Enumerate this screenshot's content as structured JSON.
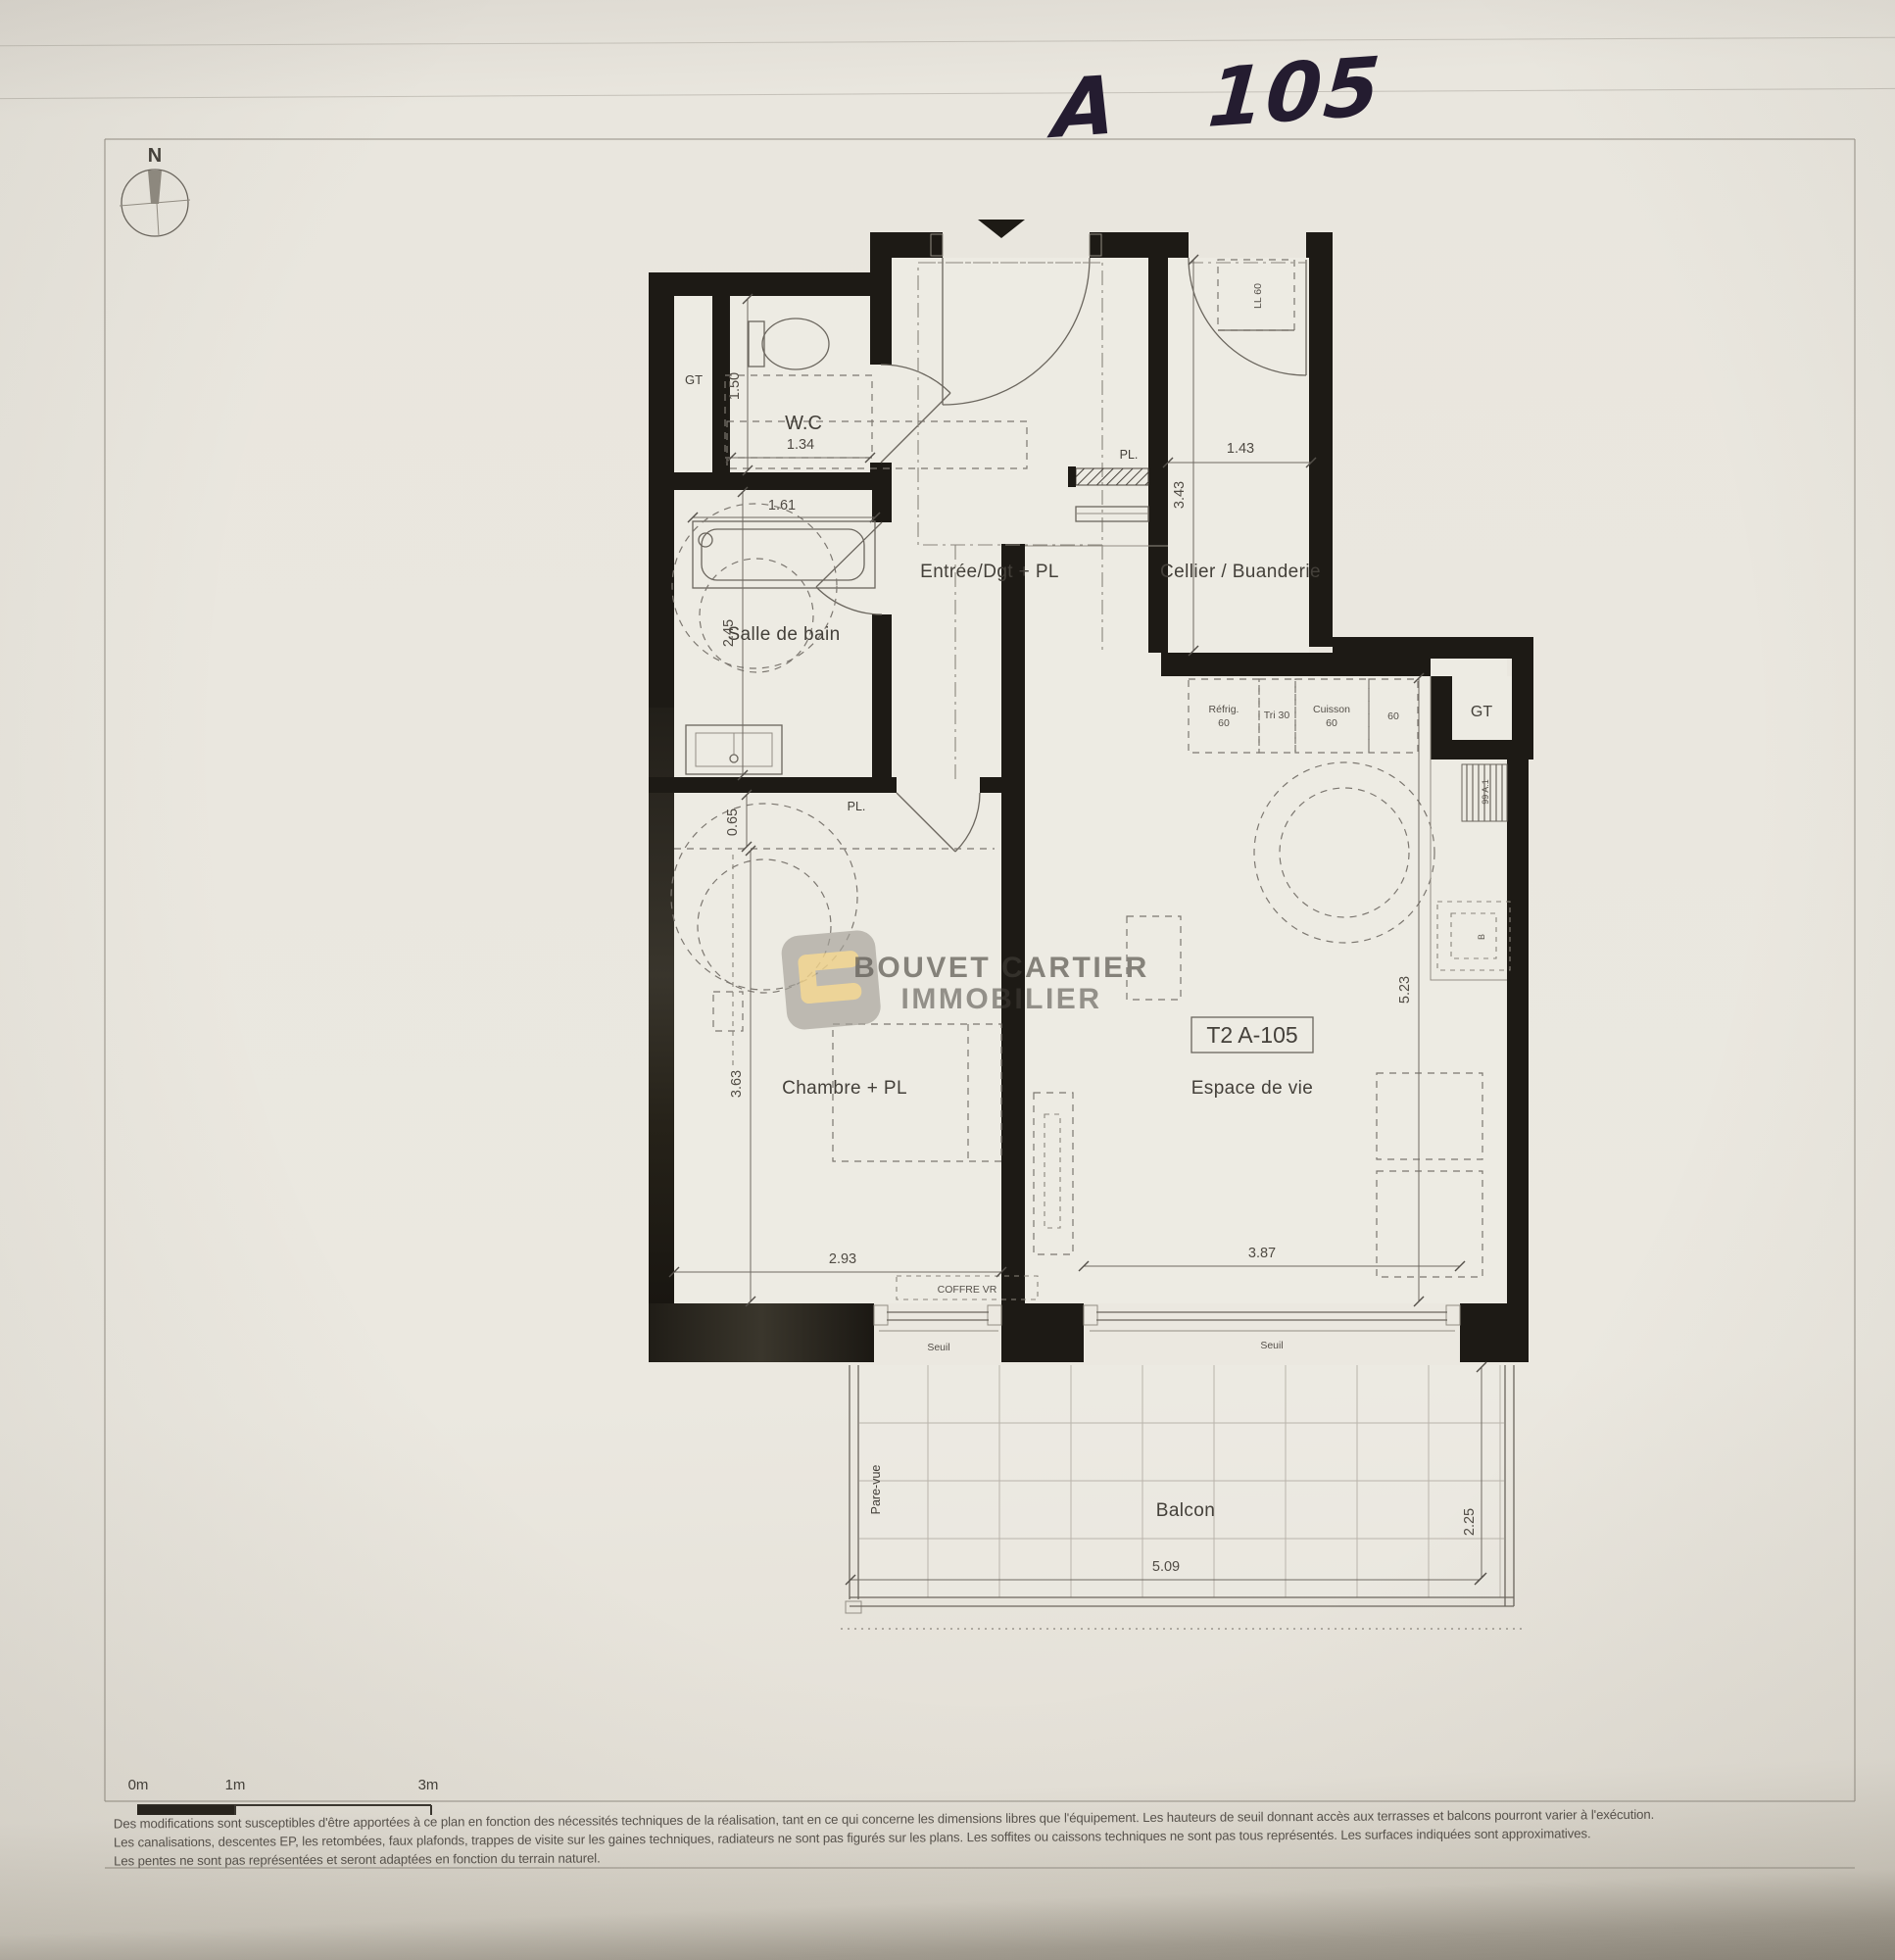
{
  "photo": {
    "handwritten": "A 105"
  },
  "compass": {
    "n": "N"
  },
  "watermark": {
    "line1": "BOUVET CARTIER",
    "line2": "IMMOBILIER"
  },
  "plan": {
    "unit_tag": "T2 A-105",
    "rooms": {
      "wc": "W.C",
      "bain": "Salle de bain",
      "entree": "Entrée/Dgt + PL",
      "cellier": "Cellier / Buanderie",
      "chambre": "Chambre + PL",
      "vie": "Espace de vie",
      "balcon": "Balcon",
      "gt_left": "GT",
      "gt_right": "GT",
      "pl_entree": "PL.",
      "pl_chambre": "PL."
    },
    "dims": {
      "wc_w": "1.34",
      "wc_d": "1.50",
      "bain_w": "1.61",
      "bain_d": "2.45",
      "cellier_d": "3.43",
      "cellier_w": "1.43",
      "pl_d": "0.65",
      "chambre_d": "3.63",
      "chambre_w": "2.93",
      "vie_w": "3.87",
      "vie_d": "5.23",
      "balcon_w": "5.09",
      "balcon_d": "2.25"
    },
    "kitchen": {
      "refrig": "Réfrig.",
      "refrig_w": "60",
      "tri": "Tri 30",
      "cuisson": "Cuisson",
      "cuisson_w": "60",
      "plan_w": "60",
      "ll": "LL 60",
      "gaine": "99 A.1",
      "evier": "B"
    },
    "notes": {
      "coffre": "COFFRE VR",
      "seuil1": "Seuil",
      "seuil2": "Seuil",
      "parevue": "Pare-vue"
    }
  },
  "scale_bar": {
    "m0": "0m",
    "m1": "1m",
    "m3": "3m"
  },
  "disclaimer": {
    "line1": "Des modifications sont susceptibles d'être apportées à ce plan en fonction des nécessités techniques de la réalisation, tant en ce qui concerne les dimensions libres que l'équipement. Les hauteurs de seuil donnant accès aux terrasses et balcons pourront varier à l'exécution.",
    "line2": "Les canalisations, descentes EP, les retombées, faux plafonds, trappes de visite sur les gaines techniques, radiateurs ne sont pas figurés sur les plans. Les soffites ou caissons techniques ne sont pas tous représentés. Les surfaces indiquées sont approximatives.",
    "line3": "Les pentes ne sont pas représentées et seront adaptées en fonction du terrain naturel."
  }
}
